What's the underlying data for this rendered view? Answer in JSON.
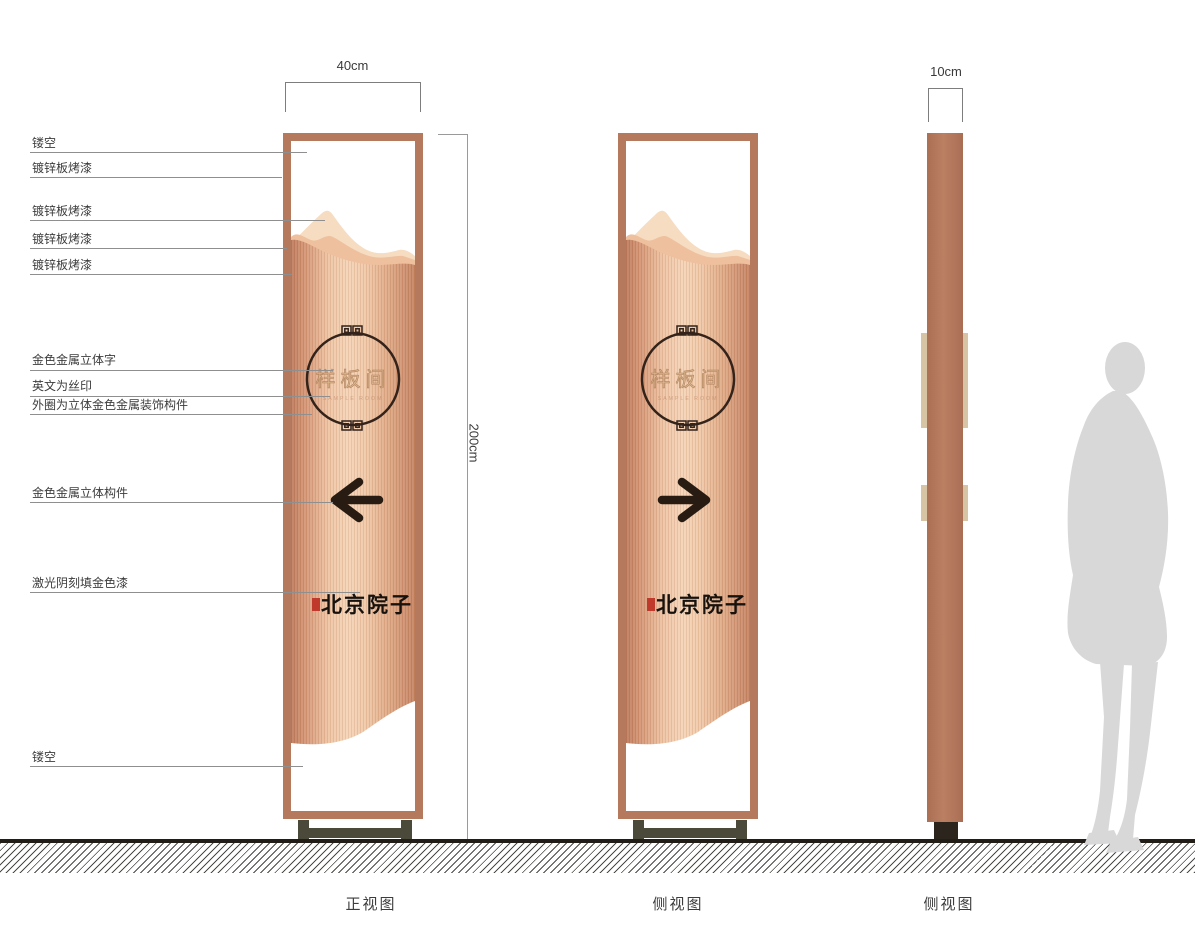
{
  "labels": [
    {
      "text": "镂空"
    },
    {
      "text": "镀锌板烤漆"
    },
    {
      "text": "镀锌板烤漆"
    },
    {
      "text": "镀锌板烤漆"
    },
    {
      "text": "镀锌板烤漆"
    },
    {
      "text": "金色金属立体字"
    },
    {
      "text": "英文为丝印"
    },
    {
      "text": "外圈为立体金色金属装饰构件"
    },
    {
      "text": "金色金属立体构件"
    },
    {
      "text": "激光阴刻填金色漆"
    },
    {
      "text": "镂空"
    }
  ],
  "dimensions": {
    "front_width": "40cm",
    "side_width": "10cm",
    "height": "200cm"
  },
  "sign": {
    "room_name": "样板间",
    "room_name_en": "SAMPLE ROOM",
    "brand_name": "北京院子"
  },
  "captions": {
    "front": "正视图",
    "side1": "侧视图",
    "side2": "侧视图"
  },
  "colors": {
    "frame_copper": "#b5795e",
    "panel_highlight": "#f5d3b5",
    "mountain_light": "#f6dcc1",
    "mountain_mid": "#eec09e",
    "ornament_dark": "#33231a",
    "arrow_dark": "#281c12",
    "gold_text": "#dcb58f",
    "protrusion_tan": "#d7c4a4",
    "base_olive": "#4b493a",
    "seal_red": "#c03a2b",
    "silhouette_gray": "#d8d8d8"
  }
}
